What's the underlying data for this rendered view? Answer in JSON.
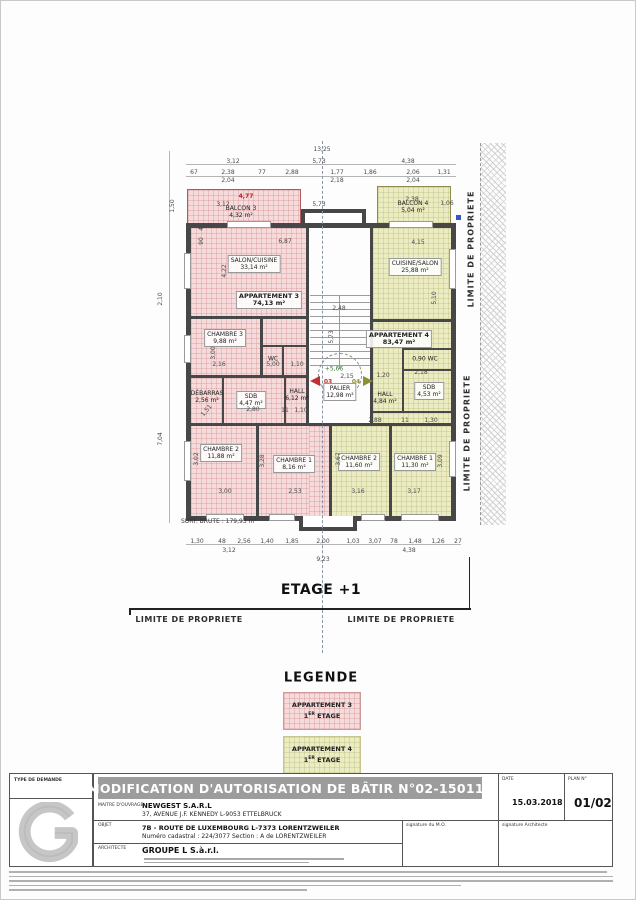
{
  "plan": {
    "floor_title": "ETAGE +1",
    "limite": "LIMITE DE PROPRIETE",
    "surf_brute": "SURF. BRUTE : 179,93 m²",
    "markers": {
      "apt3_door": "03",
      "apt4_door": "04",
      "level": "+5,66"
    },
    "rooms": [
      {
        "name": "BALCON 3",
        "area": "4,32 m²",
        "x": 240,
        "y": 211
      },
      {
        "name": "BALCON 4",
        "area": "5,04 m²",
        "x": 412,
        "y": 206
      },
      {
        "name": "SALON/CUISINE",
        "area": "33,14 m²",
        "x": 253,
        "y": 263,
        "boxed": true
      },
      {
        "name": "APPARTEMENT 3",
        "area": "74,13 m²",
        "x": 268,
        "y": 299,
        "boxed": true,
        "bold": true
      },
      {
        "name": "CHAMBRE 3",
        "area": "9,88 m²",
        "x": 224,
        "y": 337,
        "boxed": true
      },
      {
        "name": "WC",
        "area": "",
        "x": 272,
        "y": 358
      },
      {
        "name": "DÉBARRAS",
        "area": "2,56 m²",
        "x": 206,
        "y": 396
      },
      {
        "name": "SDB",
        "area": "4,47 m²",
        "x": 250,
        "y": 399,
        "boxed": true
      },
      {
        "name": "HALL",
        "area": "6,12 m²",
        "x": 296,
        "y": 394
      },
      {
        "name": "CHAMBRE 2",
        "area": "11,88 m²",
        "x": 220,
        "y": 452,
        "boxed": true
      },
      {
        "name": "CHAMBRE 1",
        "area": "8,16 m²",
        "x": 293,
        "y": 463,
        "boxed": true
      },
      {
        "name": "CUISINE/SALON",
        "area": "25,88 m²",
        "x": 414,
        "y": 266,
        "boxed": true
      },
      {
        "name": "APPARTEMENT 4",
        "area": "83,47 m²",
        "x": 398,
        "y": 338,
        "boxed": true,
        "bold": true
      },
      {
        "name": "0,90 WC",
        "area": "",
        "x": 424,
        "y": 358
      },
      {
        "name": "SDB",
        "area": "4,53 m²",
        "x": 428,
        "y": 390,
        "boxed": true
      },
      {
        "name": "HALL",
        "area": "4,84 m²",
        "x": 384,
        "y": 397
      },
      {
        "name": "CHAMBRE 2",
        "area": "11,60 m²",
        "x": 358,
        "y": 461,
        "boxed": true
      },
      {
        "name": "CHAMBRE 1",
        "area": "11,30 m²",
        "x": 414,
        "y": 461,
        "boxed": true
      },
      {
        "name": "PALIER",
        "area": "12,98 m²",
        "x": 339,
        "y": 391,
        "boxed": true
      }
    ],
    "dims": [
      {
        "t": "13,25",
        "x": 321,
        "y": 149
      },
      {
        "t": "3,12",
        "x": 232,
        "y": 161
      },
      {
        "t": "5,73",
        "x": 318,
        "y": 161
      },
      {
        "t": "4,38",
        "x": 407,
        "y": 161
      },
      {
        "t": "67",
        "x": 193,
        "y": 172
      },
      {
        "t": "2,38",
        "x": 227,
        "y": 172
      },
      {
        "t": "77",
        "x": 261,
        "y": 172
      },
      {
        "t": "2,88",
        "x": 291,
        "y": 172
      },
      {
        "t": "1,77",
        "x": 336,
        "y": 172
      },
      {
        "t": "1,86",
        "x": 369,
        "y": 172
      },
      {
        "t": "2,06",
        "x": 412,
        "y": 172
      },
      {
        "t": "1,31",
        "x": 443,
        "y": 172
      },
      {
        "t": "2,04",
        "x": 227,
        "y": 180
      },
      {
        "t": "2,18",
        "x": 336,
        "y": 180
      },
      {
        "t": "2,04",
        "x": 412,
        "y": 180
      },
      {
        "t": "4,77",
        "x": 245,
        "y": 196,
        "c": "#bb2222"
      },
      {
        "t": "3,12",
        "x": 222,
        "y": 204
      },
      {
        "t": "5,73",
        "x": 318,
        "y": 204
      },
      {
        "t": "2,38",
        "x": 411,
        "y": 199
      },
      {
        "t": "1,06",
        "x": 446,
        "y": 203
      },
      {
        "t": "1,50",
        "x": 172,
        "y": 205,
        "r": -90
      },
      {
        "t": "40",
        "x": 201,
        "y": 226,
        "r": -90
      },
      {
        "t": "90",
        "x": 201,
        "y": 240,
        "r": -90
      },
      {
        "t": "2,10",
        "x": 160,
        "y": 298,
        "r": -90
      },
      {
        "t": "7,04",
        "x": 160,
        "y": 438,
        "r": -90
      },
      {
        "t": "6,87",
        "x": 284,
        "y": 241
      },
      {
        "t": "4,22",
        "x": 224,
        "y": 270,
        "r": -90
      },
      {
        "t": "4,15",
        "x": 417,
        "y": 242
      },
      {
        "t": "2,48",
        "x": 338,
        "y": 308
      },
      {
        "t": "5,73",
        "x": 331,
        "y": 336,
        "r": -90
      },
      {
        "t": "5,10",
        "x": 434,
        "y": 297,
        "r": -90
      },
      {
        "t": "3,00",
        "x": 213,
        "y": 352,
        "r": -90
      },
      {
        "t": "2,16",
        "x": 218,
        "y": 364
      },
      {
        "t": "5,00",
        "x": 272,
        "y": 364
      },
      {
        "t": "1,10",
        "x": 296,
        "y": 364
      },
      {
        "t": "2,15",
        "x": 346,
        "y": 376
      },
      {
        "t": "1,20",
        "x": 382,
        "y": 375
      },
      {
        "t": "2,18",
        "x": 420,
        "y": 372
      },
      {
        "t": "1,51",
        "x": 206,
        "y": 410,
        "r": -50
      },
      {
        "t": "2,80",
        "x": 252,
        "y": 409
      },
      {
        "t": "11",
        "x": 284,
        "y": 410
      },
      {
        "t": "1,10",
        "x": 300,
        "y": 410
      },
      {
        "t": "2,88",
        "x": 374,
        "y": 420
      },
      {
        "t": "11",
        "x": 404,
        "y": 420
      },
      {
        "t": "1,30",
        "x": 430,
        "y": 420
      },
      {
        "t": "3,02",
        "x": 196,
        "y": 458,
        "r": -90
      },
      {
        "t": "3,28",
        "x": 262,
        "y": 460,
        "r": -90
      },
      {
        "t": "3,67",
        "x": 338,
        "y": 458,
        "r": -90
      },
      {
        "t": "3,09",
        "x": 440,
        "y": 460,
        "r": -90
      },
      {
        "t": "3,00",
        "x": 224,
        "y": 491
      },
      {
        "t": "2,53",
        "x": 294,
        "y": 491
      },
      {
        "t": "3,16",
        "x": 357,
        "y": 491
      },
      {
        "t": "3,17",
        "x": 413,
        "y": 491
      },
      {
        "t": "1,30",
        "x": 196,
        "y": 541
      },
      {
        "t": "48",
        "x": 221,
        "y": 541
      },
      {
        "t": "2,56",
        "x": 243,
        "y": 541
      },
      {
        "t": "1,40",
        "x": 266,
        "y": 541
      },
      {
        "t": "1,85",
        "x": 291,
        "y": 541
      },
      {
        "t": "2,00",
        "x": 322,
        "y": 541
      },
      {
        "t": "1,03",
        "x": 352,
        "y": 541
      },
      {
        "t": "3,07",
        "x": 374,
        "y": 541
      },
      {
        "t": "78",
        "x": 393,
        "y": 541
      },
      {
        "t": "1,48",
        "x": 414,
        "y": 541
      },
      {
        "t": "1,26",
        "x": 437,
        "y": 541
      },
      {
        "t": "27",
        "x": 457,
        "y": 541
      },
      {
        "t": "3,12",
        "x": 228,
        "y": 550
      },
      {
        "t": "4,38",
        "x": 408,
        "y": 550
      },
      {
        "t": "9,23",
        "x": 322,
        "y": 559
      }
    ]
  },
  "legend": {
    "title": "LEGENDE",
    "items": [
      {
        "name": "APPARTEMENT 3",
        "floor_num": "1",
        "floor_sup": "ER",
        "floor_word": "ETAGE",
        "color": "#f2b8b8"
      },
      {
        "name": "APPARTEMENT 4",
        "floor_num": "1",
        "floor_sup": "ER",
        "floor_word": "ETAGE",
        "color": "#ededc6"
      }
    ]
  },
  "titleblock": {
    "type_de_demande": "TYPE DE DEMANDE",
    "title": "MODIFICATION D'AUTORISATION DE BÂTIR N°02-150118",
    "maitre_label": "MAITRE D'OUVRAGE",
    "maitre_name": "NEWGEST S.A.R.L",
    "maitre_address": "37, AVENUE J.F. KENNEDY L-9053 ETTELBRUCK",
    "objet_label": "OBJET",
    "objet_line1": "7B - ROUTE DE LUXEMBOURG L-7373 LORENTZWEILER",
    "objet_line2": "Numéro cadastral : 224/3077  Section : A de LORENTZWEILER",
    "architecte_label": "ARCHITECTE",
    "architecte_name": "GROUPE L S.à.r.l.",
    "date_label": "DATE",
    "date_value": "15.03.2018",
    "plan_label": "PLAN N°",
    "plan_value": "01/02",
    "sig_mo": "signature du M.O.",
    "sig_arch": "signature Architecte"
  }
}
